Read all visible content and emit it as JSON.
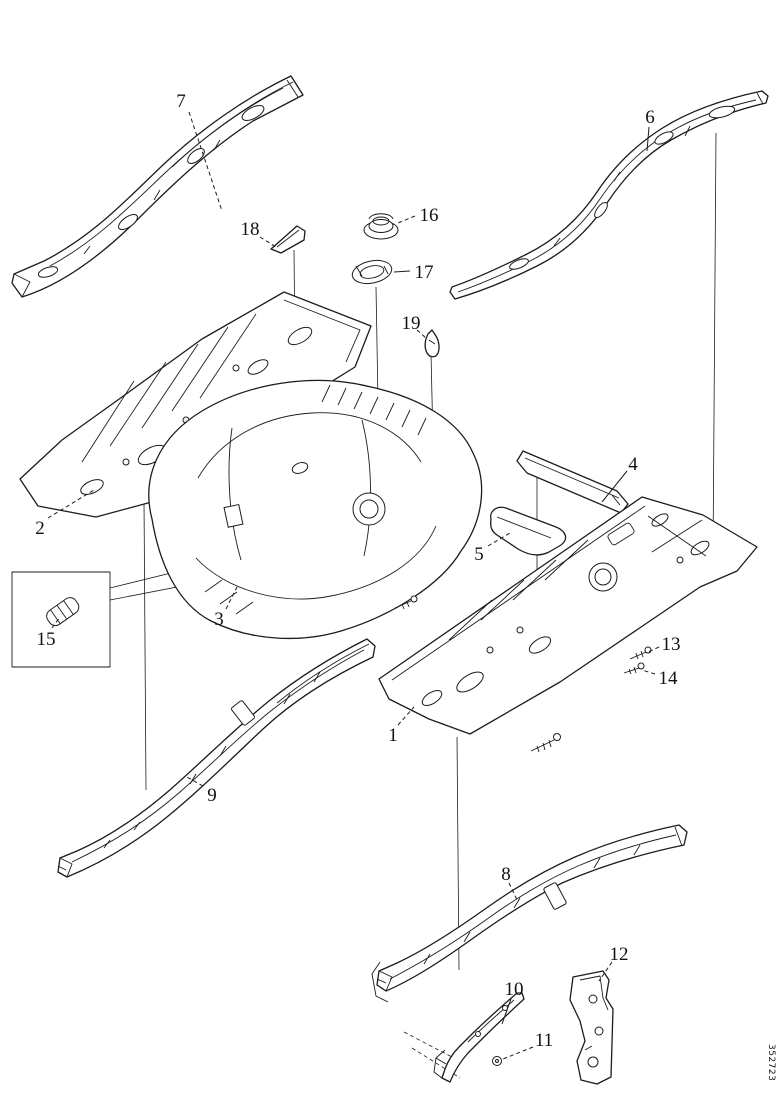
{
  "meta": {
    "ink_color": "#1c1c1c",
    "background_color": "#ffffff"
  },
  "watermark": {
    "text": "352723"
  },
  "callouts": [
    {
      "n": "1",
      "x": 393,
      "y": 741,
      "dashed": true,
      "leader": [
        [
          398,
          725
        ],
        [
          414,
          707
        ]
      ]
    },
    {
      "n": "2",
      "x": 40,
      "y": 534,
      "dashed": true,
      "leader": [
        [
          48,
          518
        ],
        [
          94,
          490
        ]
      ]
    },
    {
      "n": "3",
      "x": 219,
      "y": 625,
      "dashed": true,
      "leader": [
        [
          226,
          609
        ],
        [
          237,
          587
        ]
      ]
    },
    {
      "n": "4",
      "x": 633,
      "y": 470,
      "dashed": false,
      "leader": [
        [
          627,
          471
        ],
        [
          602,
          502
        ]
      ]
    },
    {
      "n": "5",
      "x": 479,
      "y": 560,
      "dashed": true,
      "leader": [
        [
          488,
          546
        ],
        [
          510,
          533
        ]
      ]
    },
    {
      "n": "6",
      "x": 650,
      "y": 123,
      "dashed": false,
      "leader": [
        [
          649,
          127
        ],
        [
          647,
          151
        ]
      ]
    },
    {
      "n": "7",
      "x": 181,
      "y": 107,
      "dashed": true,
      "leader": [
        [
          189,
          112
        ],
        [
          222,
          211
        ]
      ]
    },
    {
      "n": "8",
      "x": 506,
      "y": 880,
      "dashed": true,
      "leader": [
        [
          509,
          883
        ],
        [
          518,
          902
        ]
      ]
    },
    {
      "n": "9",
      "x": 212,
      "y": 801,
      "dashed": true,
      "leader": [
        [
          203,
          786
        ],
        [
          185,
          776
        ]
      ]
    },
    {
      "n": "10",
      "x": 514,
      "y": 995,
      "dashed": false,
      "leader": [
        [
          511,
          999
        ],
        [
          502,
          1024
        ]
      ]
    },
    {
      "n": "11",
      "x": 544,
      "y": 1046,
      "dashed": true,
      "leader": [
        [
          533,
          1047
        ],
        [
          503,
          1059
        ]
      ]
    },
    {
      "n": "12",
      "x": 619,
      "y": 960,
      "dashed": true,
      "leader": [
        [
          612,
          962
        ],
        [
          599,
          981
        ]
      ]
    },
    {
      "n": "13",
      "x": 671,
      "y": 650,
      "dashed": true,
      "leader": [
        [
          659,
          647
        ],
        [
          646,
          653
        ]
      ]
    },
    {
      "n": "14",
      "x": 668,
      "y": 684,
      "dashed": true,
      "leader": [
        [
          655,
          674
        ],
        [
          642,
          670
        ]
      ]
    },
    {
      "n": "15",
      "x": 46,
      "y": 645,
      "dashed": true,
      "leader": [
        [
          52,
          628
        ],
        [
          60,
          617
        ]
      ]
    },
    {
      "n": "16",
      "x": 429,
      "y": 221,
      "dashed": true,
      "leader": [
        [
          415,
          216
        ],
        [
          398,
          223
        ]
      ]
    },
    {
      "n": "17",
      "x": 424,
      "y": 278,
      "dashed": false,
      "leader": [
        [
          410,
          271
        ],
        [
          394,
          272
        ]
      ]
    },
    {
      "n": "18",
      "x": 250,
      "y": 235,
      "dashed": true,
      "leader": [
        [
          260,
          237
        ],
        [
          276,
          247
        ]
      ]
    },
    {
      "n": "19",
      "x": 411,
      "y": 329,
      "dashed": true,
      "leader": [
        [
          417,
          330
        ],
        [
          427,
          339
        ]
      ]
    }
  ]
}
